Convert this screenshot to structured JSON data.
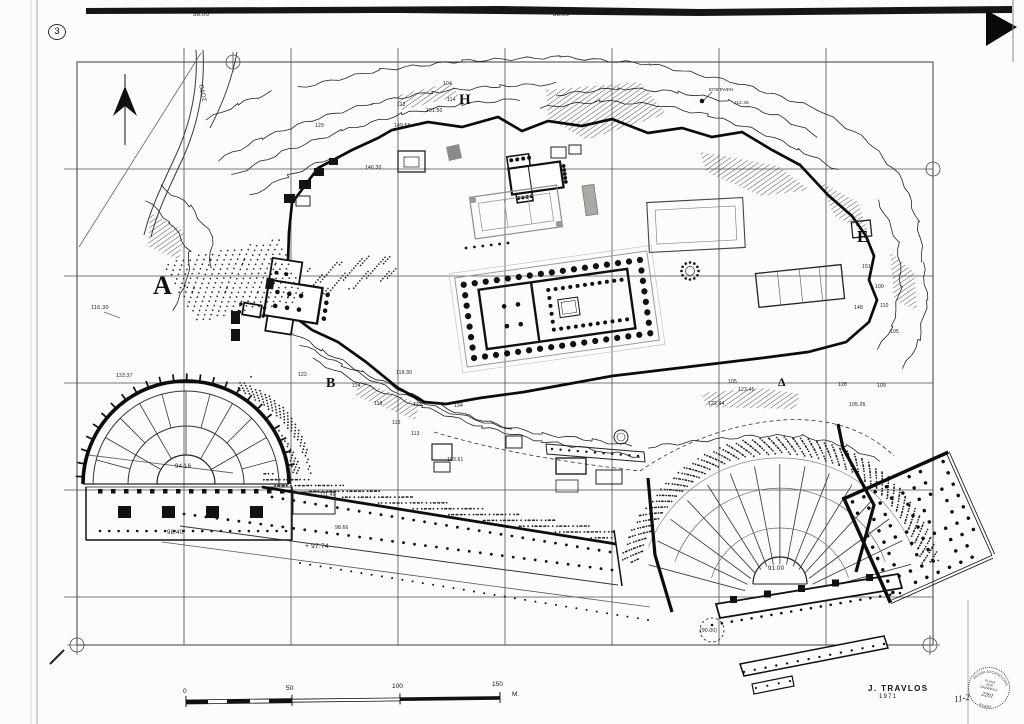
{
  "drawing": {
    "sheet_number": "3"
  },
  "credit": {
    "name": "J. TRAVLOS",
    "year": "1971"
  },
  "stamp": {
    "arc_top": "AGORA EXCAVATIONS",
    "line1": "PLANS",
    "line2": "AND",
    "line3": "DRAWINGS",
    "number": "2201",
    "arc_bottom": "ATHENS",
    "note": "11-2"
  },
  "scale_bar": {
    "ticks": [
      "0",
      "50",
      "100",
      "150"
    ],
    "unit": "M."
  },
  "area_letters": [
    {
      "t": "A",
      "x": 153,
      "y": 273,
      "s": 26
    },
    {
      "t": "H",
      "x": 459,
      "y": 93,
      "s": 15
    },
    {
      "t": "B",
      "x": 326,
      "y": 377,
      "s": 14
    },
    {
      "t": "Δ",
      "x": 778,
      "y": 376,
      "s": 12
    },
    {
      "t": "E",
      "x": 857,
      "y": 228,
      "s": 17
    }
  ],
  "labels": [
    {
      "t": "38.00",
      "x": 193,
      "y": 12,
      "s": 6
    },
    {
      "t": "38.00",
      "x": 553,
      "y": 12,
      "s": 6
    },
    {
      "t": "ΟΔΟΣ",
      "x": 203,
      "y": 84,
      "s": 6,
      "r": 78
    },
    {
      "t": "129",
      "x": 315,
      "y": 124,
      "s": 5
    },
    {
      "t": "104",
      "x": 443,
      "y": 82,
      "s": 5
    },
    {
      "t": "114",
      "x": 447,
      "y": 98,
      "s": 5
    },
    {
      "t": "112",
      "x": 397,
      "y": 103,
      "s": 5
    },
    {
      "t": "151.50",
      "x": 426,
      "y": 109,
      "s": 5
    },
    {
      "t": "149.58",
      "x": 394,
      "y": 124,
      "s": 5
    },
    {
      "t": "146.30",
      "x": 365,
      "y": 166,
      "s": 5
    },
    {
      "t": "ΕΠΙΓΡΑΦΗ",
      "x": 709,
      "y": 88,
      "s": 4.6
    },
    {
      "t": "112.45",
      "x": 734,
      "y": 101,
      "s": 4.6
    },
    {
      "t": "116.30",
      "x": 91,
      "y": 306,
      "s": 5.5
    },
    {
      "t": "133.37",
      "x": 116,
      "y": 374,
      "s": 5
    },
    {
      "t": "122",
      "x": 298,
      "y": 373,
      "s": 5
    },
    {
      "t": "119.30",
      "x": 396,
      "y": 371,
      "s": 5
    },
    {
      "t": "114",
      "x": 352,
      "y": 384,
      "s": 5
    },
    {
      "t": "118",
      "x": 374,
      "y": 402,
      "s": 5
    },
    {
      "t": "123",
      "x": 413,
      "y": 403,
      "s": 5
    },
    {
      "t": "134",
      "x": 454,
      "y": 404,
      "s": 5
    },
    {
      "t": "115",
      "x": 392,
      "y": 421,
      "s": 5
    },
    {
      "t": "113",
      "x": 411,
      "y": 432,
      "s": 5
    },
    {
      "t": "103.61",
      "x": 447,
      "y": 458,
      "s": 5
    },
    {
      "t": "105",
      "x": 728,
      "y": 380,
      "s": 5
    },
    {
      "t": "123.46",
      "x": 738,
      "y": 388,
      "s": 5
    },
    {
      "t": "122.44",
      "x": 708,
      "y": 402,
      "s": 5
    },
    {
      "t": "128",
      "x": 838,
      "y": 383,
      "s": 5
    },
    {
      "t": "109",
      "x": 877,
      "y": 384,
      "s": 5
    },
    {
      "t": "105.26",
      "x": 849,
      "y": 403,
      "s": 5
    },
    {
      "t": "151",
      "x": 862,
      "y": 265,
      "s": 5
    },
    {
      "t": "100",
      "x": 875,
      "y": 285,
      "s": 5
    },
    {
      "t": "110",
      "x": 880,
      "y": 304,
      "s": 5
    },
    {
      "t": "148",
      "x": 854,
      "y": 306,
      "s": 5
    },
    {
      "t": "105",
      "x": 890,
      "y": 330,
      "s": 5
    },
    {
      "t": "91.00",
      "x": 768,
      "y": 566,
      "s": 6
    },
    {
      "t": "(90.00)",
      "x": 700,
      "y": 629,
      "s": 5
    },
    {
      "t": "94.16",
      "x": 175,
      "y": 464,
      "s": 6
    },
    {
      "t": "98.40",
      "x": 167,
      "y": 530,
      "s": 6
    },
    {
      "t": "111.49",
      "x": 320,
      "y": 493,
      "s": 5
    },
    {
      "t": "98.66",
      "x": 335,
      "y": 526,
      "s": 5
    },
    {
      "t": "+ 97.74",
      "x": 305,
      "y": 544,
      "s": 6.5
    }
  ]
}
